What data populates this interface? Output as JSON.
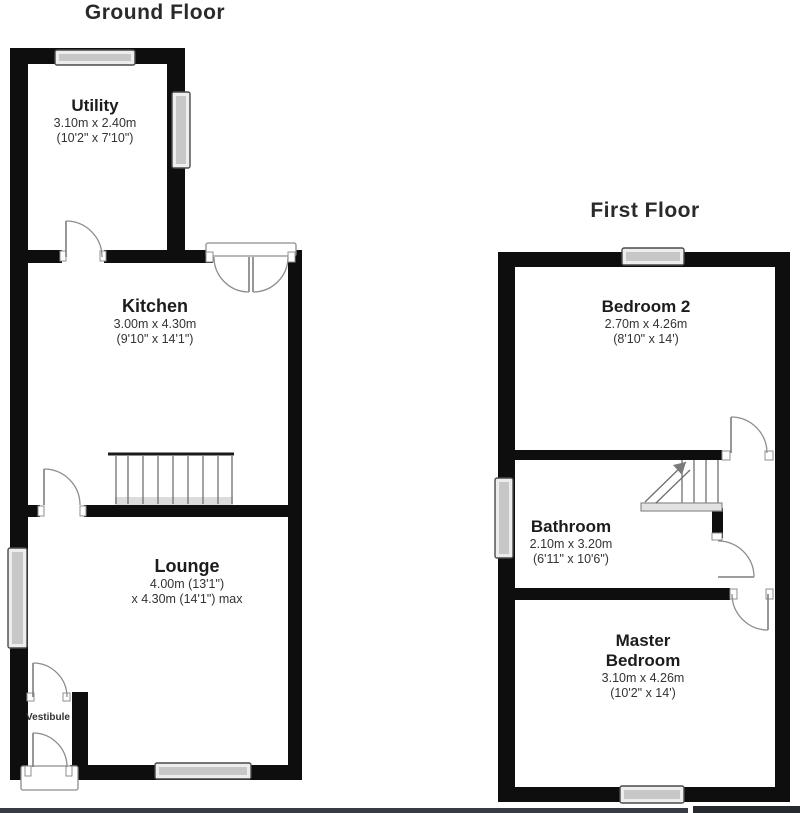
{
  "ground_floor": {
    "title": "Ground Floor",
    "rooms": {
      "utility": {
        "name": "Utility",
        "dims_metric": "3.10m x 2.40m",
        "dims_imperial": "(10'2\" x 7'10\")"
      },
      "kitchen": {
        "name": "Kitchen",
        "dims_metric": "3.00m x 4.30m",
        "dims_imperial": "(9'10\" x 14'1\")"
      },
      "lounge": {
        "name": "Lounge",
        "dims_line1": "4.00m (13'1\")",
        "dims_line2": "x 4.30m (14'1\") max"
      },
      "vestibule": {
        "name": "Vestibule"
      }
    }
  },
  "first_floor": {
    "title": "First Floor",
    "rooms": {
      "bedroom2": {
        "name": "Bedroom 2",
        "dims_metric": "2.70m x 4.26m",
        "dims_imperial": "(8'10\" x 14')"
      },
      "bathroom": {
        "name": "Bathroom",
        "dims_metric": "2.10m x 3.20m",
        "dims_imperial": "(6'11\" x 10'6\")"
      },
      "master": {
        "name_line1": "Master",
        "name_line2": "Bedroom",
        "dims_metric": "3.10m x 4.26m",
        "dims_imperial": "(10'2\" x 14')"
      }
    }
  },
  "colors": {
    "wall": "#0e0e0e",
    "drawing_line": "#8d8d8d",
    "window_fill": "#ededed",
    "text": "#1f1f1f",
    "bottom_edge_bar": "#33373c"
  }
}
